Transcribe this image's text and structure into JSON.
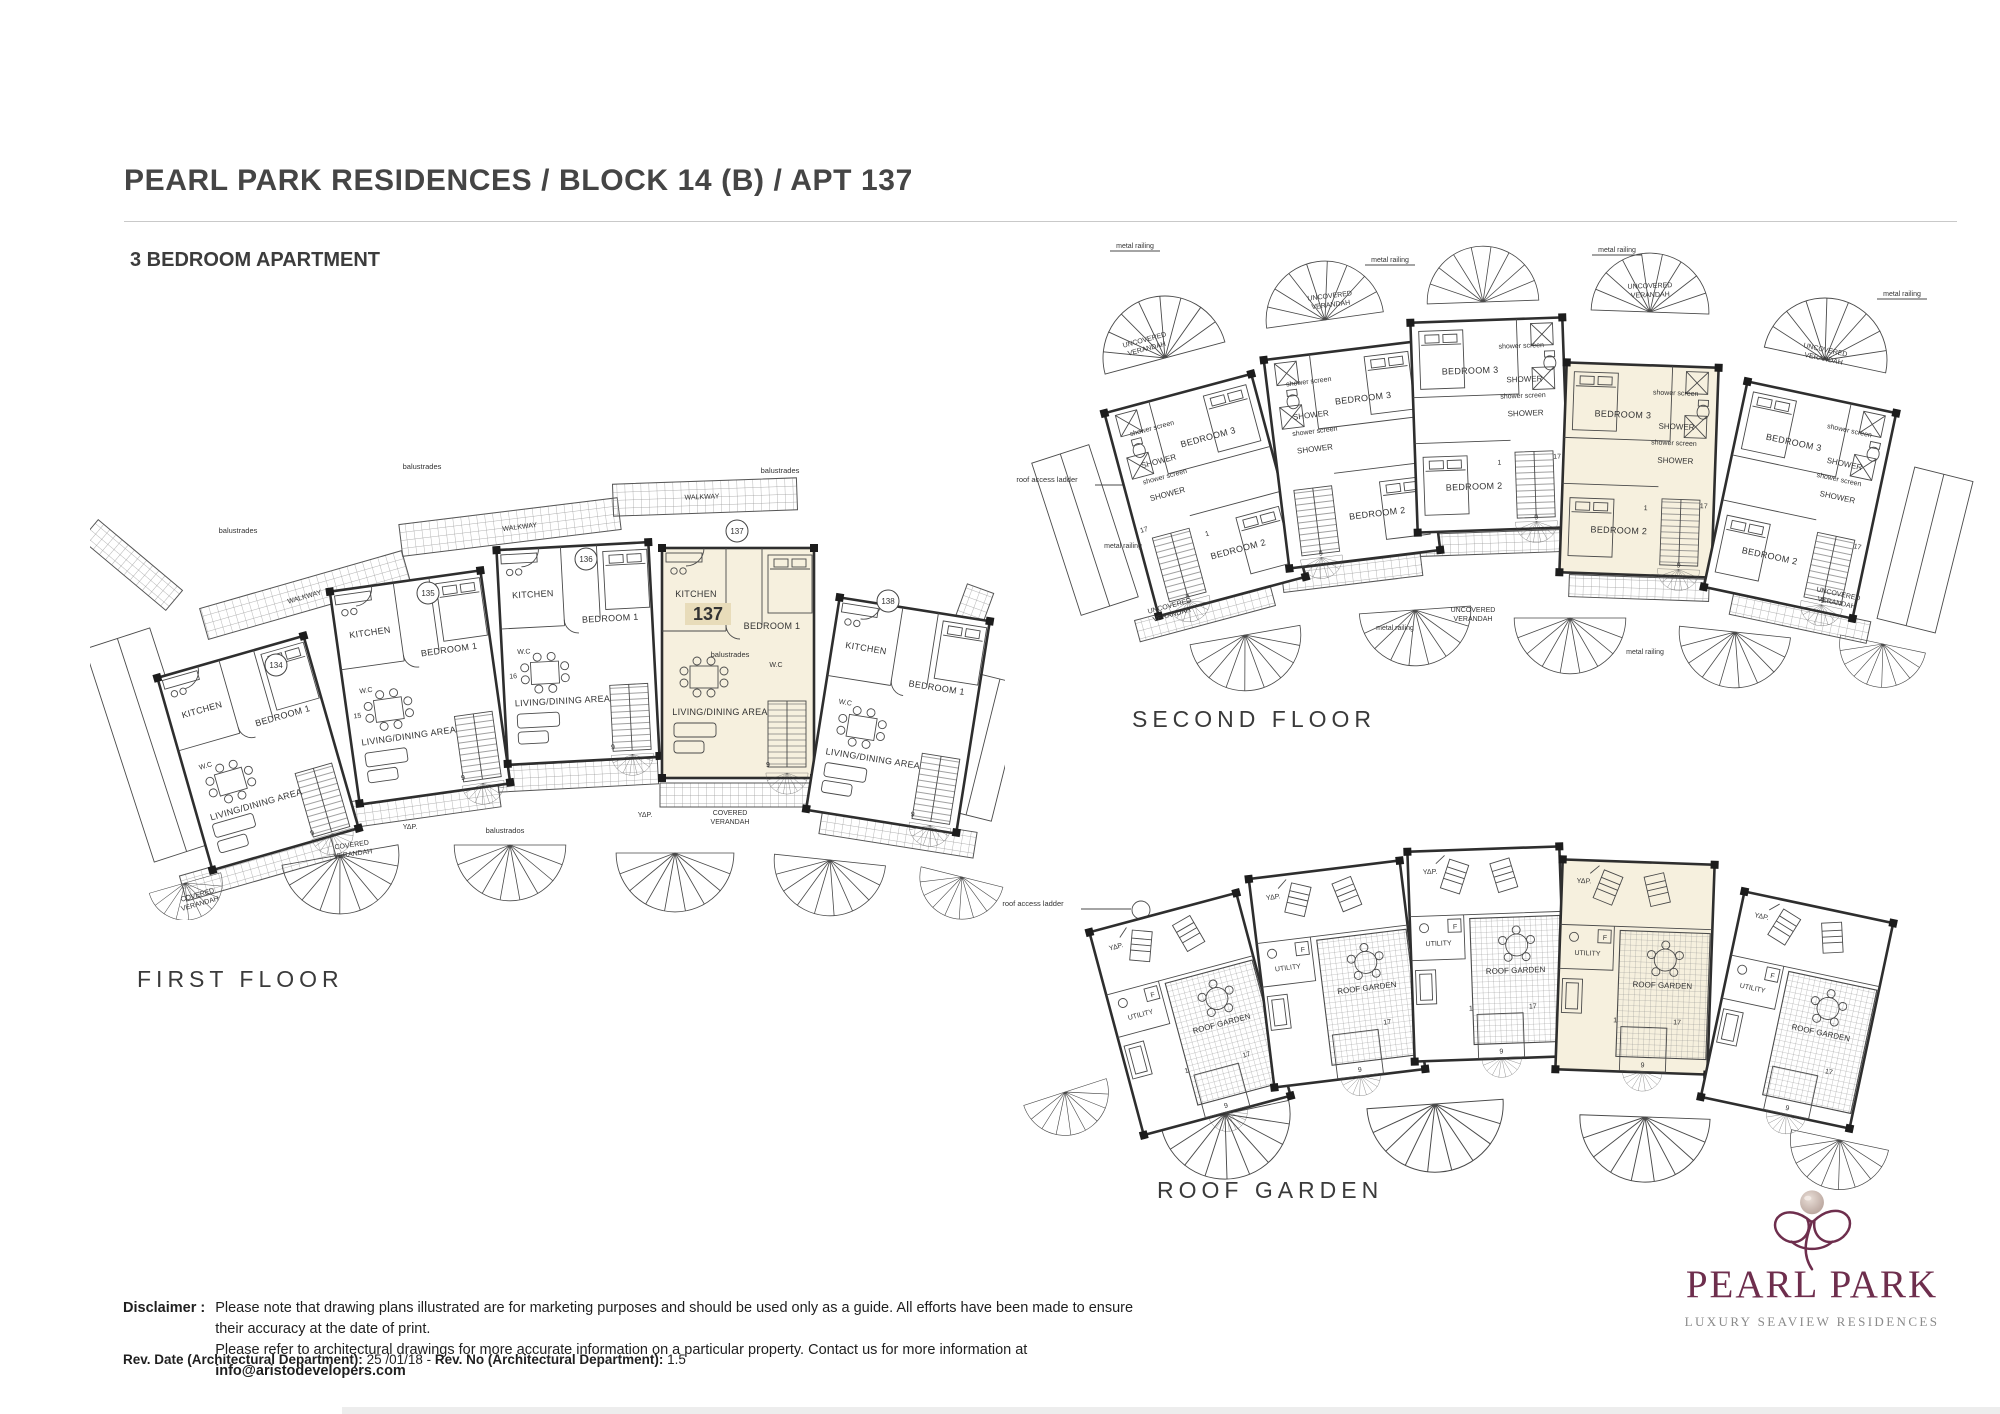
{
  "page": {
    "title": "PEARL PARK RESIDENCES / BLOCK 14 (B) / APT 137",
    "subtitle": "3 BEDROOM APARTMENT"
  },
  "plans": {
    "first": {
      "caption": "FIRST FLOOR"
    },
    "second": {
      "caption": "SECOND FLOOR"
    },
    "roof": {
      "caption": "ROOF GARDEN"
    }
  },
  "units": {
    "u134": "134",
    "u135": "135",
    "u136": "136",
    "u137": "137",
    "u138": "138",
    "highlight": "137"
  },
  "labels": {
    "walkway": "WALKWAY",
    "kitchen": "KITCHEN",
    "bedroom1": "BEDROOM 1",
    "bedroom2": "BEDROOM 2",
    "bedroom3": "BEDROOM 3",
    "wc": "W.C",
    "living": "LIVING/DINING AREA",
    "covered": "COVERED",
    "uncovered": "UNCOVERED",
    "verandah": "VERANDAH",
    "balustrades": "balustrades",
    "balustrados": "balustrados",
    "metal_railing": "metal railing",
    "shower": "SHOWER",
    "shower_screen": "shower screen",
    "roof_access_ladder": "roof access ladder",
    "roof_garden": "ROOF GARDEN",
    "utility": "UTILITY",
    "f": "F",
    "ydp": "ΥΔΡ."
  },
  "stair_numbers": {
    "n1": "1",
    "n9": "9",
    "n15": "15",
    "n16": "16",
    "n17": "17"
  },
  "footer": {
    "disclaimer_label": "Disclaimer :",
    "disclaimer_line1": "Please note that drawing plans illustrated are for marketing purposes and should be used only as a guide. All efforts have been made to ensure their accuracy at the date of print.",
    "disclaimer_line2": "Please refer to architectural drawings for more accurate information on a particular property. Contact us for more information at ",
    "disclaimer_email": "info@aristodevelopers.com",
    "rev_date_label": "Rev. Date (Architectural Department):",
    "rev_date_value": " 25 /01/18",
    "rev_separator": " - ",
    "rev_no_label": "Rev. No (Architectural Department):",
    "rev_no_value": " 1.5"
  },
  "logo": {
    "name": "PEARL PARK",
    "tagline": "LUXURY SEAVIEW RESIDENCES",
    "brand_color": "#6e2e4d",
    "tagline_color": "#8a8a8a"
  },
  "colors": {
    "highlight_fill": "#f6f0de",
    "badge_fill": "#e8dcba",
    "plan_line": "#4a4a4a"
  }
}
